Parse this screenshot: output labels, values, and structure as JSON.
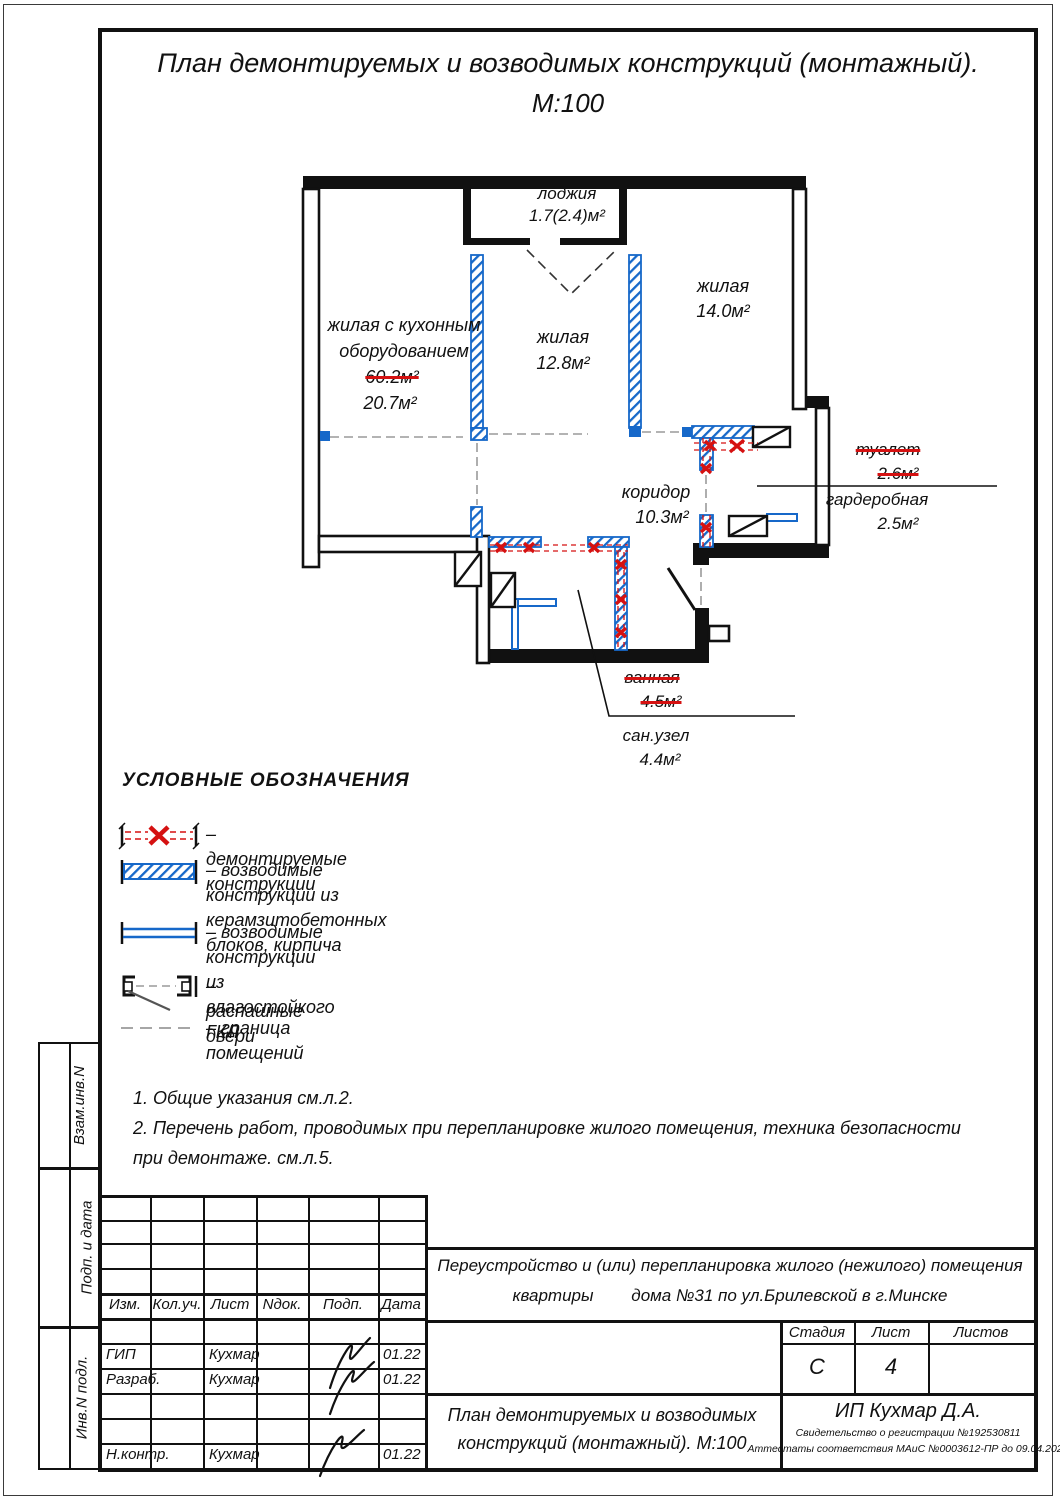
{
  "title": {
    "line1": "План демонтируемых и возводимых конструкций (монтажный).",
    "line2": "М:100"
  },
  "plan": {
    "rooms": {
      "loggia": {
        "name": "лоджия",
        "area": "1.7(2.4)м²"
      },
      "living_14": {
        "name": "жилая",
        "area": "14.0м²"
      },
      "living_kitchen": {
        "name_line1": "жилая с кухонным",
        "name_line2": "оборудованием",
        "area_old": "60.2м²",
        "area_new": "20.7м²"
      },
      "living_12": {
        "name": "жилая",
        "area": "12.8м²"
      },
      "corridor": {
        "name": "коридор",
        "area": "10.3м²"
      },
      "toilet": {
        "name": "туалет",
        "area": "2.6м²"
      },
      "wardrobe": {
        "name": "гардеробная",
        "area": "2.5м²"
      },
      "bathroom": {
        "name": "ванная",
        "area": "4.5м²"
      },
      "san_unit": {
        "name": "сан.узел",
        "area": "4.4м²"
      }
    }
  },
  "legend": {
    "title": "УСЛОВНЫЕ ОБОЗНАЧЕНИЯ",
    "items": [
      {
        "label": "– демонтируемые конструкции"
      },
      {
        "label": "– возводимые конструкции из\nкерамзитобетонных блоков, кирпича"
      },
      {
        "label": "– возводимые конструкции\nиз влагостойкого ГКЛ"
      },
      {
        "label": "– распашные двери"
      },
      {
        "label": "– граница помещений"
      }
    ]
  },
  "notes": "1. Общие указания см.л.2.\n2. Перечень работ, проводимых при перепланировке жилого помещения, техника безопасности\nпри демонтаже. см.л.5.",
  "sidebar": {
    "cells": [
      "Взам.инв.N",
      "Подп. и дата",
      "Инв.N подл."
    ]
  },
  "titleblock": {
    "columns": [
      "Изм.",
      "Кол.уч.",
      "Лист",
      "Nдок.",
      "Подп.",
      "Дата"
    ],
    "rows": [
      {
        "role": "ГИП",
        "name": "Кухмар",
        "date": "01.22"
      },
      {
        "role": "Разраб.",
        "name": "Кухмар",
        "date": "01.22"
      },
      {
        "role": "Н.контр.",
        "name": "Кухмар",
        "date": "01.22"
      }
    ],
    "project_line1": "Переустройство и (или) перепланировка жилого (нежилого) помещения",
    "project_line2": "квартиры        дома №31 по ул.Брилевской в г.Минске",
    "stage_label": "Стадия",
    "sheet_label": "Лист",
    "sheets_label": "Листов",
    "stage": "С",
    "sheet": "4",
    "sheets": "",
    "doc_name_line1": "План демонтируемых и возводимых",
    "doc_name_line2": "конструкций (монтажный). М:100",
    "org": "ИП Кухмар Д.А.",
    "org_cert1": "Свидетельство о регистрации №192530811",
    "org_cert2": "Аттестаты соответствия МАиС №0003612-ПР до 09.04.2026"
  },
  "colors": {
    "new_wall": "#1668c9",
    "demolition": "#d51111"
  }
}
